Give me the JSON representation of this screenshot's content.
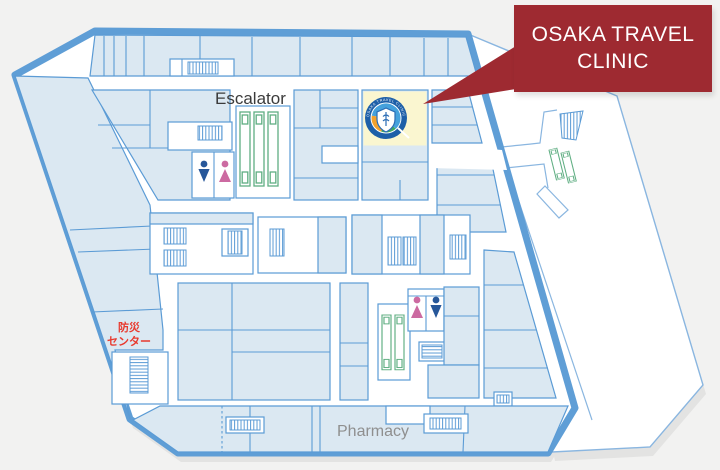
{
  "window": {
    "width": 720,
    "height": 470,
    "content_type": "building-floor-map"
  },
  "callout": {
    "title_line1": "OSAKA TRAVEL",
    "title_line2": "CLINIC",
    "background": "#9e2a31",
    "text_color": "#ffffff"
  },
  "labels": {
    "escalator": "Escalator",
    "pharmacy": "Pharmacy",
    "disaster_center_line1": "防災",
    "disaster_center_line2": "センター"
  },
  "clinic_logo": {
    "ring_text": "OSAKA TRAVEL CLINIC"
  },
  "colors": {
    "page_background": "#f2f2f1",
    "building_outline": "#5f9ed6",
    "room_fill": "#dbe8f2",
    "corridor_fill": "#ffffff",
    "clinic_highlight_room": "#faf6d0",
    "escalator_symbol_green": "#5fae82",
    "male_restroom_icon": "#27579a",
    "female_restroom_icon": "#cc6aa1",
    "disaster_center_text": "#e8392e",
    "callout_red": "#9e2a31",
    "shadow": "#e3e3e2"
  },
  "icons": {
    "male_restroom": "male-figure",
    "female_restroom": "female-figure",
    "escalator": "green-striped-escalator",
    "stairs": "hatched-stairs",
    "elevator": "hatched-elevator-bank"
  }
}
